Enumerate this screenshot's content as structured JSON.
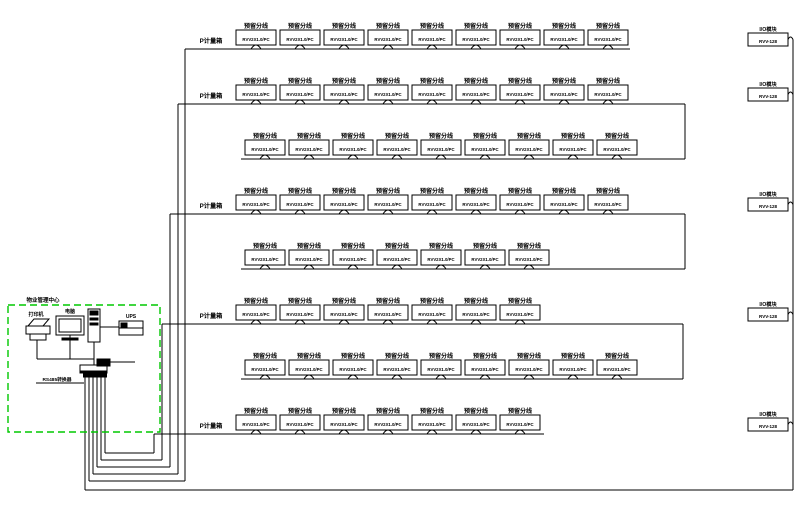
{
  "diagram": {
    "title": "remote-meter-reading-system-wiring-diagram",
    "colors": {
      "line": "#000000",
      "text": "#000000",
      "boundary_green": "#00c800",
      "background": "#ffffff"
    },
    "meter_branch": {
      "label": "预留分线",
      "model": "RVV2X1.0/PC"
    },
    "row_label": "P计量箱",
    "io_module": {
      "label": "I/O模块",
      "model": "RVV-128",
      "count": 5
    },
    "rows": [
      {
        "labeled": true,
        "boxes": 9
      },
      {
        "labeled": true,
        "boxes": 9
      },
      {
        "labeled": false,
        "boxes": 9
      },
      {
        "labeled": true,
        "boxes": 9
      },
      {
        "labeled": false,
        "boxes": 7
      },
      {
        "labeled": true,
        "boxes": 7
      },
      {
        "labeled": false,
        "boxes": 9
      },
      {
        "labeled": true,
        "boxes": 7
      }
    ],
    "control_room": {
      "title": "物业管理中心",
      "printer": "打印机",
      "computer": "电脑",
      "ups": "UPS",
      "converter": "RS485转换器"
    }
  }
}
